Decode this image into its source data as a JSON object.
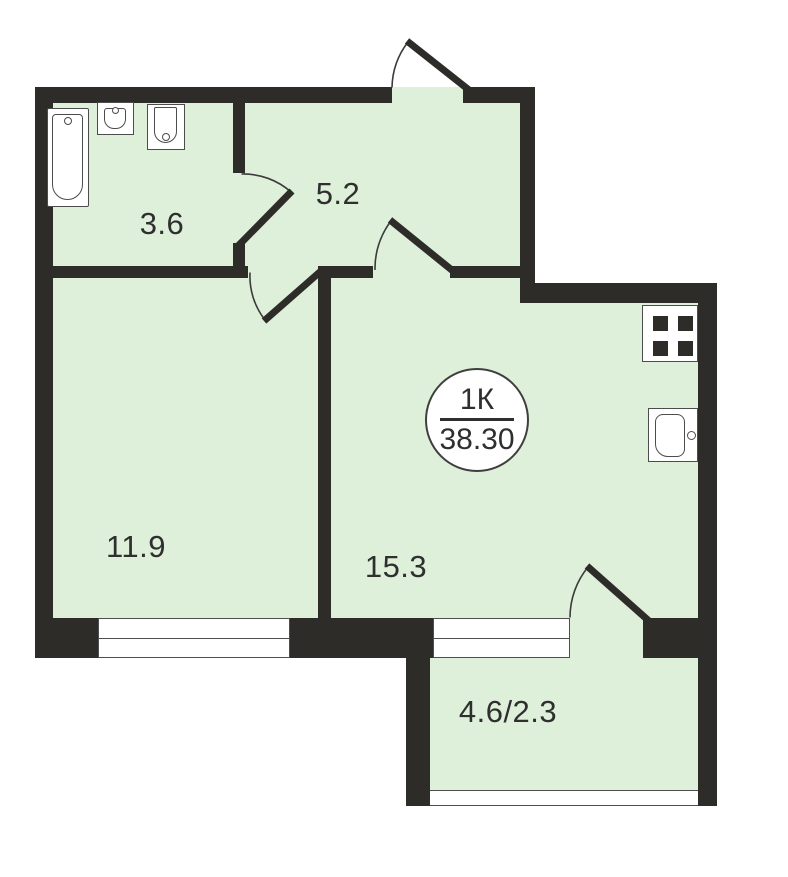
{
  "badge": {
    "apartment_type": "1К",
    "total_area": "38.30"
  },
  "rooms": {
    "bathroom": {
      "area": "3.6"
    },
    "hallway": {
      "area": "5.2"
    },
    "bedroom": {
      "area": "11.9"
    },
    "living_kitchen": {
      "area": "15.3"
    },
    "balcony": {
      "area": "4.6/2.3"
    }
  },
  "colors": {
    "wall": "#2e2c29",
    "floor_fill": "#def0da",
    "fixture_outline": "#4c4c4c",
    "text": "#2f2f2f",
    "background": "#ffffff"
  },
  "icons": [
    "bathtub-icon",
    "bathroom-sink-icon",
    "toilet-icon",
    "stove-icon",
    "kitchen-sink-icon",
    "entry-door-icon",
    "bathroom-door-icon",
    "bedroom-door-icon",
    "living-door-icon",
    "balcony-door-icon"
  ]
}
